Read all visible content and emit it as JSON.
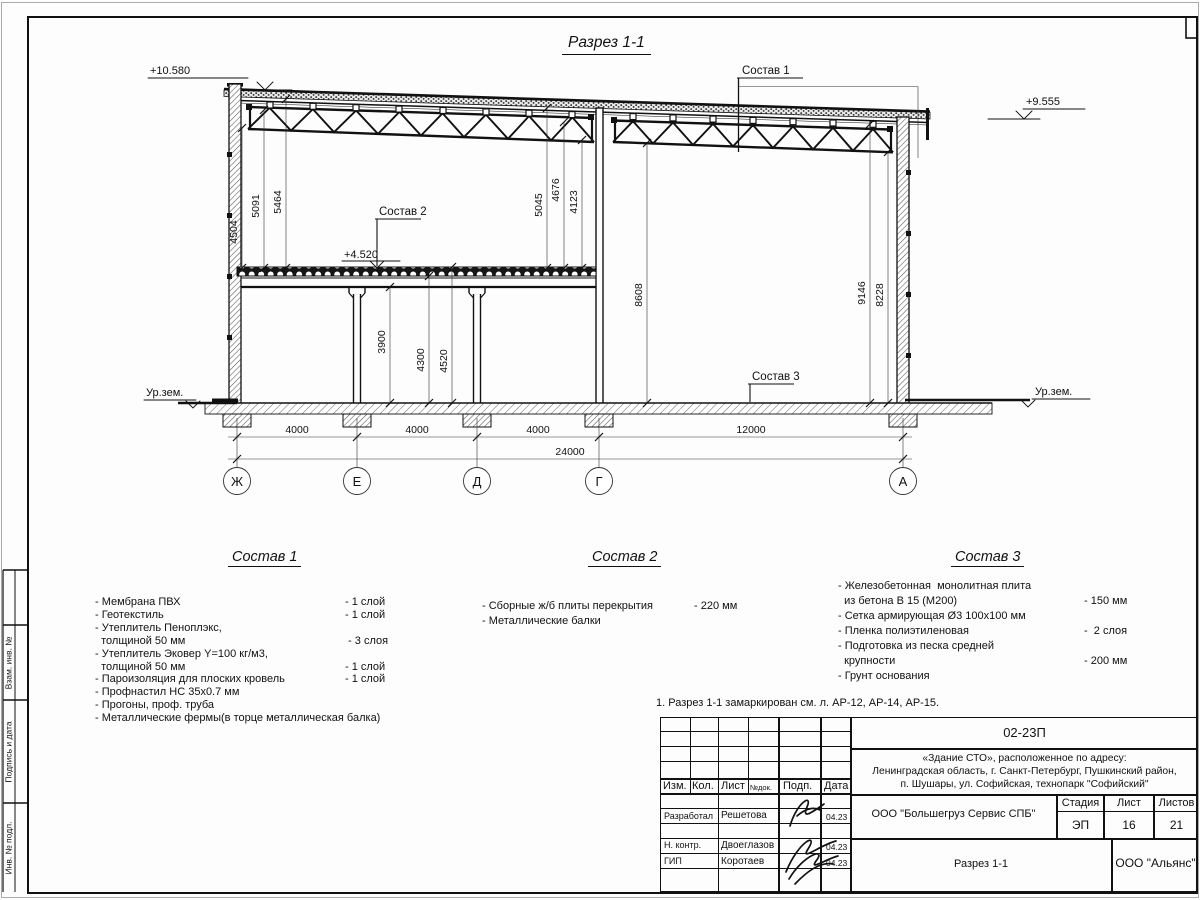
{
  "page_title": "Разрез 1-1",
  "elevations": {
    "top_left": "+10.580",
    "top_right": "+9.555",
    "slab": "+4.520",
    "ground_left": "Ур.зем.",
    "ground_right": "Ур.зем."
  },
  "leaders": {
    "s1": "Состав 1",
    "s2": "Состав 2",
    "s3": "Состав 3"
  },
  "dims": {
    "d4504": "4504",
    "d5091": "5091",
    "d5464": "5464",
    "d5045": "5045",
    "d4676": "4676",
    "d4123": "4123",
    "d8608": "8608",
    "d9146": "9146",
    "d8228": "8228",
    "d3900": "3900",
    "d4300": "4300",
    "d4520": "4520",
    "span1": "4000",
    "span2": "4000",
    "span3": "4000",
    "span4": "12000",
    "total": "24000"
  },
  "axes": {
    "a1": "Ж",
    "a2": "Е",
    "a3": "Д",
    "a4": "Г",
    "a5": "А"
  },
  "sostav1": {
    "title": "Состав 1",
    "rows": [
      {
        "t": "- Мембрана ПВХ",
        "v": "- 1 слой"
      },
      {
        "t": "- Геотекстиль",
        "v": "- 1 слой"
      },
      {
        "t": "- Утеплитель Пеноплэкс,",
        "v": ""
      },
      {
        "t": "  толщиной 50 мм",
        "v": " - 3 слоя"
      },
      {
        "t": "- Утеплитель Эковер Y=100 кг/м3,",
        "v": ""
      },
      {
        "t": "  толщиной 50 мм",
        "v": "- 1 слой"
      },
      {
        "t": "- Пароизоляция для плоских кровель",
        "v": "- 1 слой"
      },
      {
        "t": "- Профнастил НС 35х0.7 мм",
        "v": ""
      },
      {
        "t": "- Прогоны, проф. труба",
        "v": ""
      },
      {
        "t": "- Металлические фермы(в торце металлическая балка)",
        "v": ""
      }
    ]
  },
  "sostav2": {
    "title": "Состав 2",
    "rows": [
      {
        "t": "- Сборные ж/б плиты перекрытия",
        "v": "- 220 мм"
      },
      {
        "t": "- Металлические балки",
        "v": ""
      }
    ]
  },
  "sostav3": {
    "title": "Состав 3",
    "rows": [
      {
        "t": "- Железобетонная  монолитная плита",
        "v": ""
      },
      {
        "t": "  из бетона В 15 (М200)",
        "v": "- 150 мм"
      },
      {
        "t": "- Сетка армирующая Ø3 100х100 мм",
        "v": ""
      },
      {
        "t": "- Пленка полиэтиленовая",
        "v": "-  2 слоя"
      },
      {
        "t": "- Подготовка из песка средней",
        "v": ""
      },
      {
        "t": "  крупности",
        "v": "- 200 мм"
      },
      {
        "t": "- Грунт основания",
        "v": ""
      }
    ]
  },
  "note": "1. Разрез 1-1 замаркирован см. л. АР-12, АР-14, АР-15.",
  "titleblock": {
    "code": "02-23П",
    "object_line1": "«Здание СТО», расположенное по адресу:",
    "object_line2": "Ленинградская область, г. Санкт-Петербург, Пушкинский район,",
    "object_line3": "п. Шушары, ул. Софийская, технопарк \"Софийский\"",
    "cols": {
      "izm": "Изм.",
      "kol": "Кол.",
      "list": "Лист",
      "ndok": "№док.",
      "podp": "Подп.",
      "data": "Дата"
    },
    "rows": [
      {
        "role": "Разработал",
        "name": "Решетова",
        "date": "04.23"
      },
      {
        "role": "Н. контр.",
        "name": "Двоеглазов",
        "date": "04.23"
      },
      {
        "role": "ГИП",
        "name": "Коротаев",
        "date": "04.23"
      }
    ],
    "org": "ООО \"Большегруз Сервис СПБ\"",
    "stage_label": "Стадия",
    "sheet_label": "Лист",
    "sheets_label": "Листов",
    "stage": "ЭП",
    "sheet": "16",
    "sheets": "21",
    "doc_name": "Разрез 1-1",
    "company": "ООО \"Альянс\""
  },
  "side_stamp": {
    "f1": "Взам. инв. №",
    "f2": "Подпись и дата",
    "f3": "Инв. № подл."
  }
}
